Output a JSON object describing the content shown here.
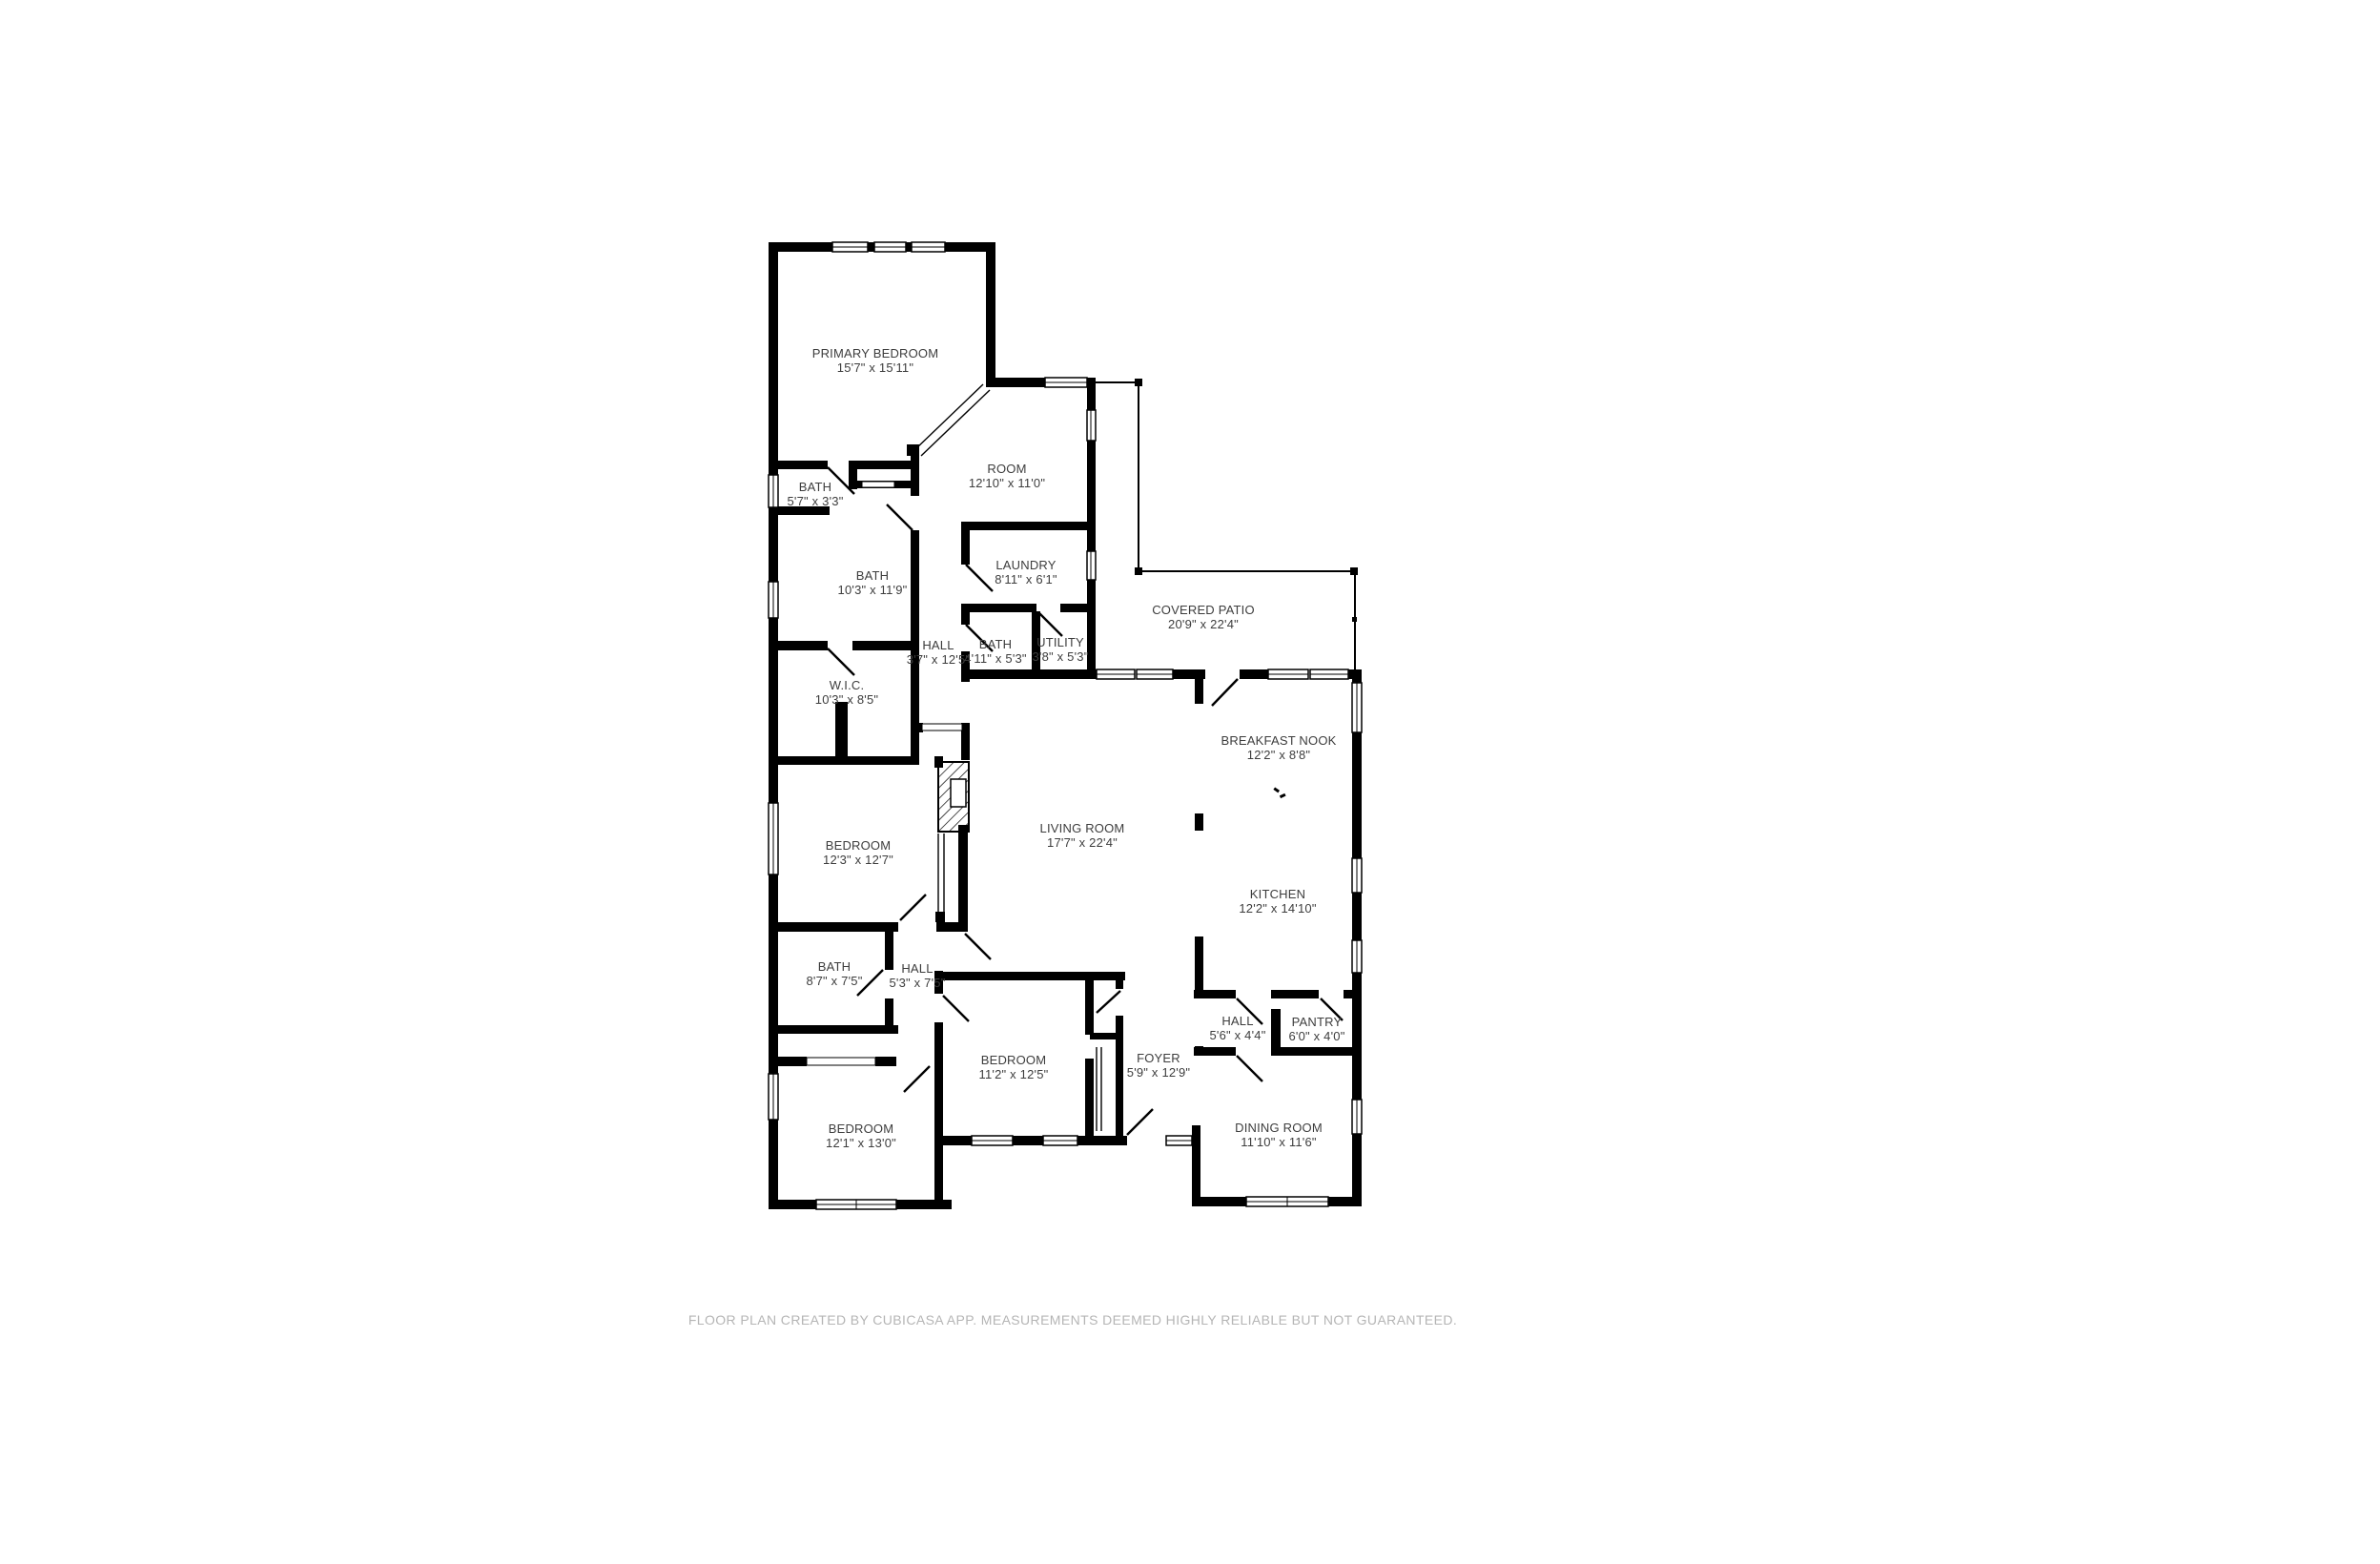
{
  "colors": {
    "background": "#ffffff",
    "wall": "#000000",
    "room_label": "#3d3d3d",
    "footer_text": "#b5b5b5"
  },
  "rooms": [
    {
      "id": "primary-bedroom",
      "name": "PRIMARY BEDROOM",
      "dims": "15'7\" x 15'11\""
    },
    {
      "id": "bath-small",
      "name": "BATH",
      "dims": "5'7\" x 3'3\""
    },
    {
      "id": "room",
      "name": "ROOM",
      "dims": "12'10\" x 11'0\""
    },
    {
      "id": "laundry",
      "name": "LAUNDRY",
      "dims": "8'11\" x 6'1\""
    },
    {
      "id": "bath-primary",
      "name": "BATH",
      "dims": "10'3\" x 11'9\""
    },
    {
      "id": "hall-upper",
      "name": "HALL",
      "dims": "3'7\" x 12'5\""
    },
    {
      "id": "bath-hall",
      "name": "BATH",
      "dims": "4'11\" x 5'3\""
    },
    {
      "id": "utility",
      "name": "UTILITY",
      "dims": "3'8\" x 5'3\""
    },
    {
      "id": "covered-patio",
      "name": "COVERED PATIO",
      "dims": "20'9\" x 22'4\""
    },
    {
      "id": "wic",
      "name": "W.I.C.",
      "dims": "10'3\" x 8'5\""
    },
    {
      "id": "breakfast-nook",
      "name": "BREAKFAST NOOK",
      "dims": "12'2\" x 8'8\""
    },
    {
      "id": "living-room",
      "name": "LIVING ROOM",
      "dims": "17'7\" x 22'4\""
    },
    {
      "id": "kitchen",
      "name": "KITCHEN",
      "dims": "12'2\" x 14'10\""
    },
    {
      "id": "bedroom-mid",
      "name": "BEDROOM",
      "dims": "12'3\" x 12'7\""
    },
    {
      "id": "bath-lower",
      "name": "BATH",
      "dims": "8'7\" x 7'5\""
    },
    {
      "id": "hall-lower",
      "name": "HALL",
      "dims": "5'3\" x 7'5\""
    },
    {
      "id": "bedroom-right",
      "name": "BEDROOM",
      "dims": "11'2\" x 12'5\""
    },
    {
      "id": "foyer",
      "name": "FOYER",
      "dims": "5'9\" x 12'9\""
    },
    {
      "id": "hall-kitchen",
      "name": "HALL",
      "dims": "5'6\" x 4'4\""
    },
    {
      "id": "pantry",
      "name": "PANTRY",
      "dims": "6'0\" x 4'0\""
    },
    {
      "id": "dining-room",
      "name": "DINING ROOM",
      "dims": "11'10\" x 11'6\""
    },
    {
      "id": "bedroom-bottom",
      "name": "BEDROOM",
      "dims": "12'1\" x 13'0\""
    }
  ],
  "footer": {
    "text": "FLOOR PLAN CREATED BY CUBICASA APP. MEASUREMENTS DEEMED HIGHLY RELIABLE BUT NOT GUARANTEED."
  }
}
